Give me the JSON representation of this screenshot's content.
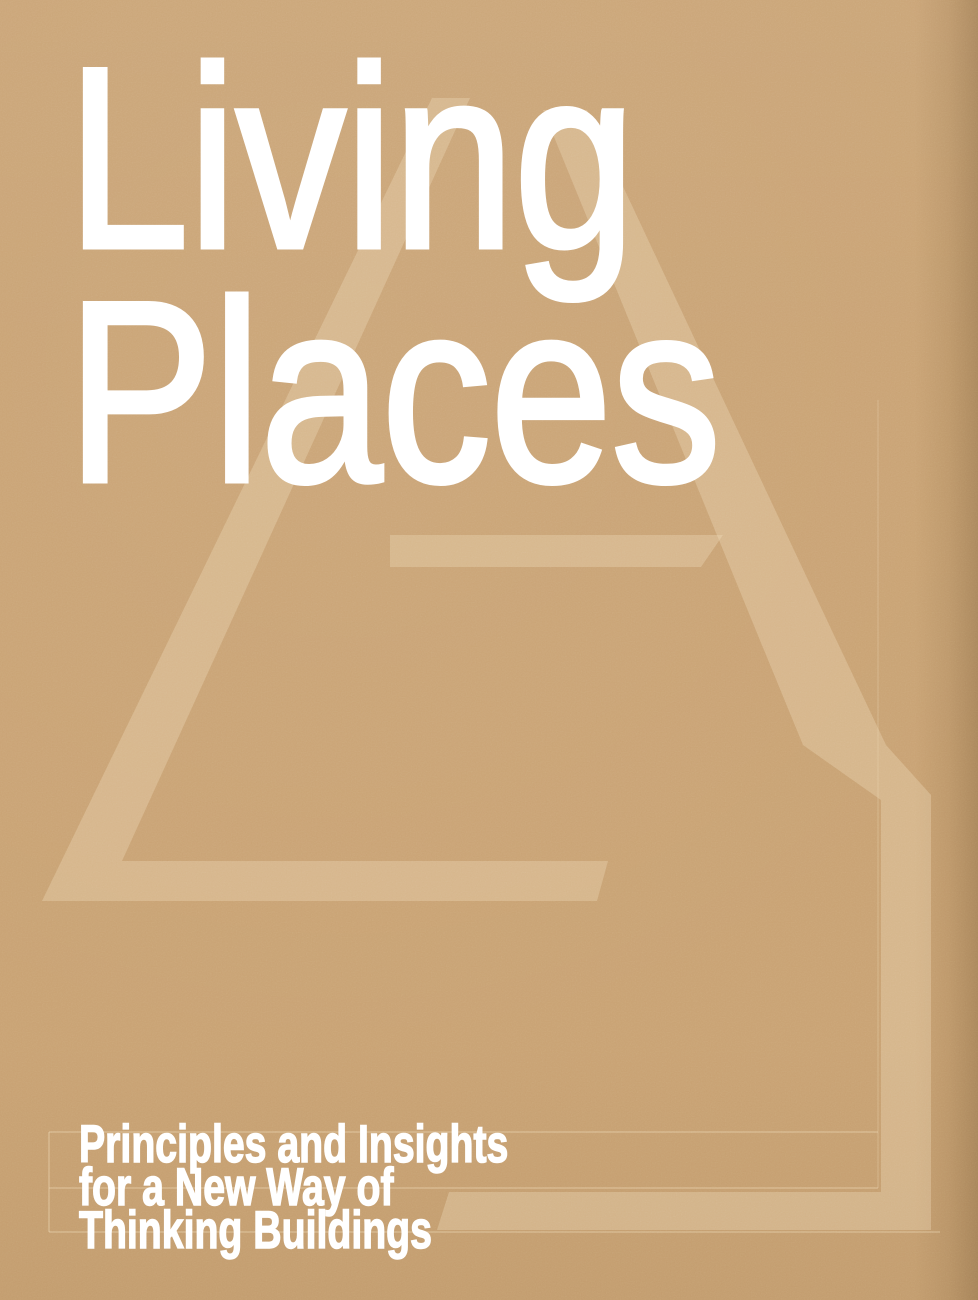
{
  "cover": {
    "title": {
      "line1": "Living",
      "line2": "Places"
    },
    "subtitle": {
      "line1": "Principles and Insights",
      "line2": "for a New Way of",
      "line3": "Thinking Buildings"
    },
    "colors": {
      "background": "#c9a273",
      "title_text": "#ffffff",
      "subtitle_text": "#ffffff",
      "watermark": "#f3e1bd"
    },
    "watermark_icon": "a-frame-house-letterform-watermark"
  }
}
